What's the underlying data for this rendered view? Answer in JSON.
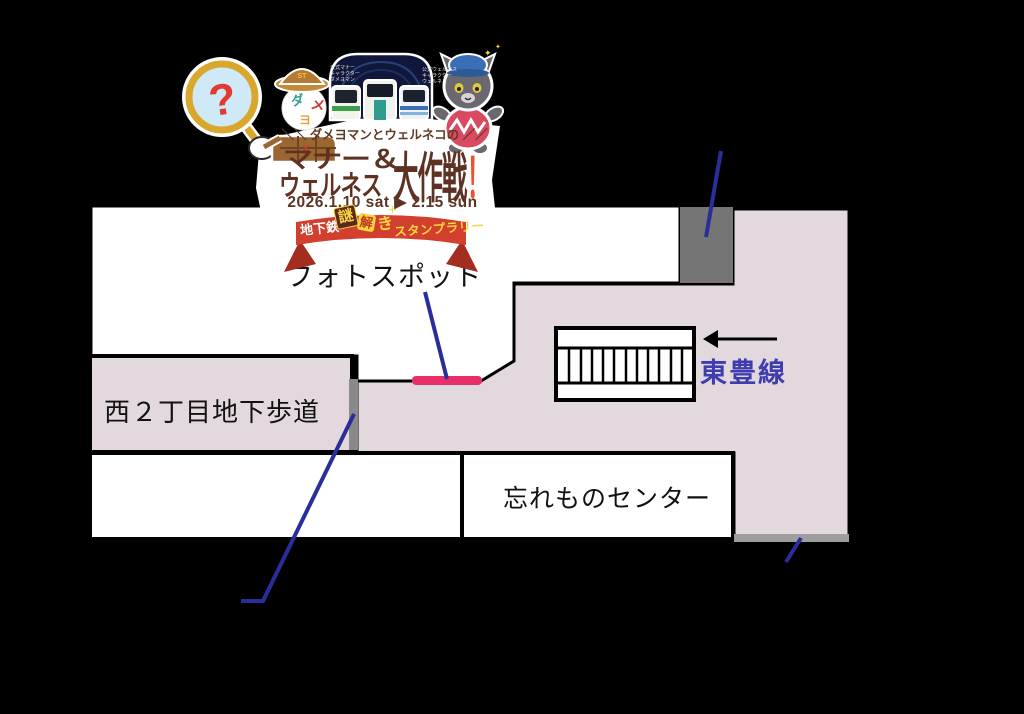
{
  "page": {
    "background": "#000000"
  },
  "logo": {
    "tagline": "＼＼ ダメヨマンとウェルネコの ／／",
    "title_line1": "マナー＆",
    "title_line2": "ウェルネス",
    "title_line3_main": "大作戦",
    "title_exclamation": "！",
    "date_range": "2026.1.10 sat ▶ 2.15 sun",
    "ribbon": {
      "prefix": "地下鉄",
      "tile1": "謎",
      "tile2": "解",
      "tile3": "き",
      "sparkle": "＋",
      "suffix": "スタンプラリー"
    },
    "detective": {
      "magnifier_glyph": "?",
      "hat_badge": "ST",
      "face_char1": "ダ",
      "face_char2": "メ",
      "face_char3": "ヨ",
      "caption_lines": [
        "公式マナー",
        "キャラクター",
        "ダメヨマン"
      ]
    },
    "cat": {
      "caption_lines": [
        "公式ウェルネス",
        "キャラクター",
        "ウェルネコ"
      ],
      "sparkle1": "✦",
      "sparkle2": "✦"
    },
    "colors": {
      "title_brown": "#5e3122",
      "date_brown": "#5d3423",
      "ribbon_red": "#d23f2e",
      "ribbon_fold_red": "#a32d1f",
      "ribbon_yellow": "#f7d63f",
      "exclamation_orange": "#e8552e",
      "question_red": "#e03a31"
    }
  },
  "map": {
    "labels": {
      "photo_spot": "フォトスポット",
      "underpass": "西２丁目地下歩道",
      "toho_line": "東豊線",
      "lost_and_found": "忘れものセンター"
    },
    "colors": {
      "floor_pink": "#e3d8de",
      "marker_pink": "#e73069",
      "pointer_blue": "#2a2e9b",
      "toho_text_blue": "#3e3cae",
      "gray_block": "#757575",
      "gray_bar": "#8a8a8a",
      "gray_strip": "#9e9e9e"
    }
  }
}
